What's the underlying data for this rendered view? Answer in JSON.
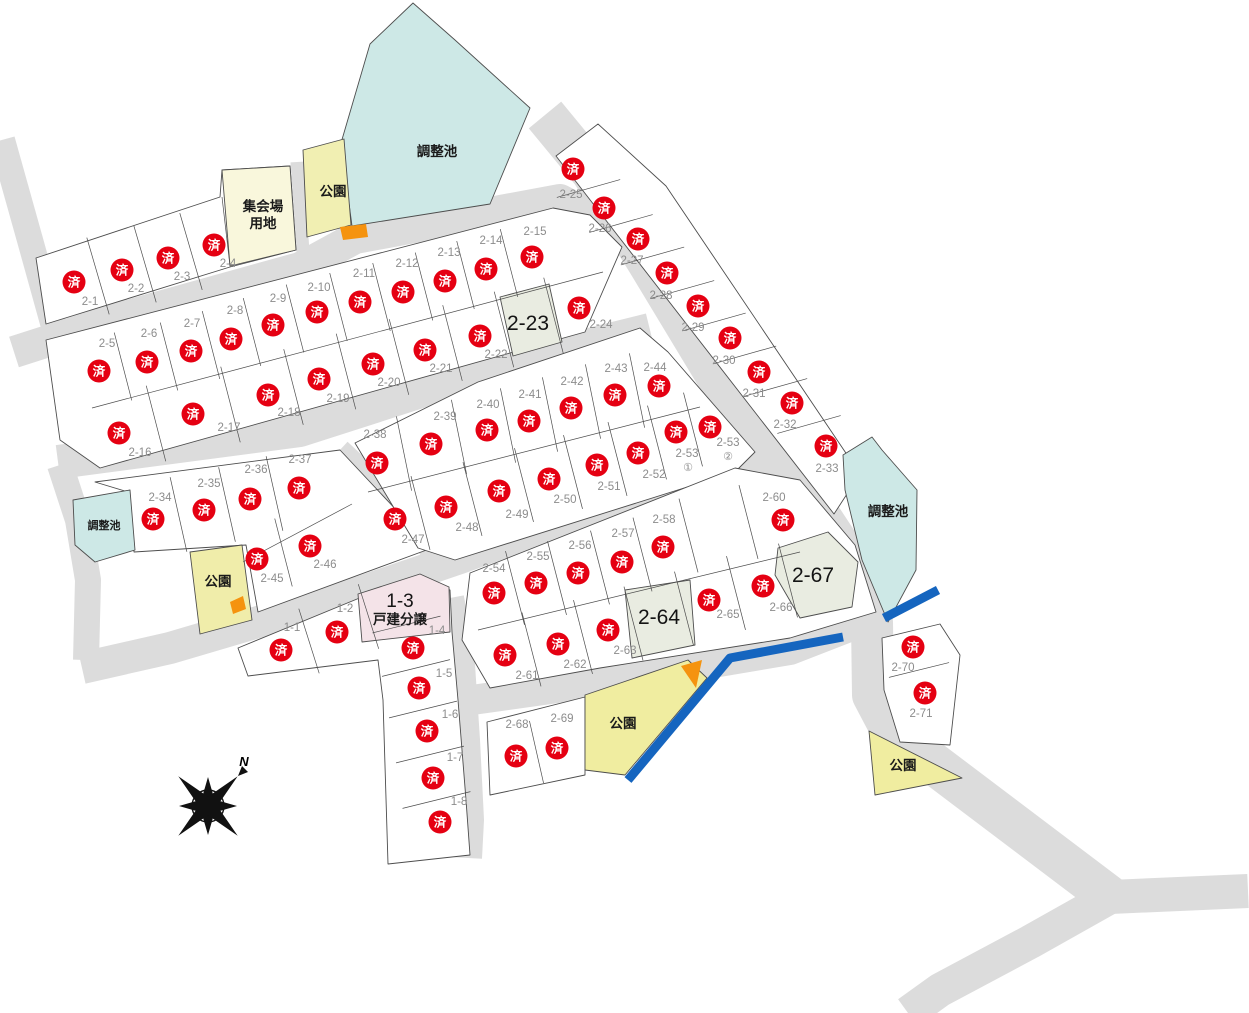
{
  "map": {
    "width": 1249,
    "height": 1013
  },
  "sold_mark": "済",
  "compass": {
    "label": "N"
  },
  "colors": {
    "road": "#dcdcdc",
    "lot_fill": "#ffffff",
    "lot_stroke": "#4d4d4d",
    "pond_fill": "#cde8e6",
    "park_fill": "#f0edaa",
    "hall_fill": "#f9f7dc",
    "pink_fill": "#f4e3e8",
    "available_fill": "#e9ece1",
    "sold_red": "#e50012",
    "water_blue": "#1565bf",
    "orange": "#f5930f",
    "label_gray": "#8c8c8c"
  },
  "area_labels": [
    {
      "text": "調整池",
      "x": 437,
      "y": 152,
      "size": 13.5
    },
    {
      "text": "調整池",
      "x": 104,
      "y": 525,
      "size": 11
    },
    {
      "text": "調整池",
      "x": 888,
      "y": 512,
      "size": 13.5
    },
    {
      "text": "公園",
      "x": 333,
      "y": 192,
      "size": 13.5
    },
    {
      "text": "公園",
      "x": 218,
      "y": 582,
      "size": 13.5
    },
    {
      "text": "公園",
      "x": 623,
      "y": 724,
      "size": 13.5
    },
    {
      "text": "公園",
      "x": 903,
      "y": 766,
      "size": 13.5
    },
    {
      "lines": [
        "集会場",
        "用地"
      ],
      "x": 263,
      "y": 207,
      "size": 13.5,
      "line_h": 17
    }
  ],
  "lots": [
    {
      "id": "2-1",
      "label": "2-1",
      "status": "sold",
      "x": 74,
      "y": 282,
      "lx": 90,
      "ly": 301
    },
    {
      "id": "2-2",
      "label": "2-2",
      "status": "sold",
      "x": 122,
      "y": 270,
      "lx": 136,
      "ly": 288
    },
    {
      "id": "2-3",
      "label": "2-3",
      "status": "sold",
      "x": 168,
      "y": 258,
      "lx": 182,
      "ly": 276
    },
    {
      "id": "2-4",
      "label": "2-4",
      "status": "sold",
      "x": 214,
      "y": 245,
      "lx": 228,
      "ly": 263
    },
    {
      "id": "2-5",
      "label": "2-5",
      "status": "sold",
      "x": 99,
      "y": 371,
      "lx": 107,
      "ly": 343
    },
    {
      "id": "2-6",
      "label": "2-6",
      "status": "sold",
      "x": 147,
      "y": 362,
      "lx": 149,
      "ly": 333
    },
    {
      "id": "2-7",
      "label": "2-7",
      "status": "sold",
      "x": 191,
      "y": 351,
      "lx": 192,
      "ly": 323
    },
    {
      "id": "2-8",
      "label": "2-8",
      "status": "sold",
      "x": 231,
      "y": 339,
      "lx": 235,
      "ly": 310
    },
    {
      "id": "2-9",
      "label": "2-9",
      "status": "sold",
      "x": 273,
      "y": 325,
      "lx": 278,
      "ly": 298
    },
    {
      "id": "2-10",
      "label": "2-10",
      "status": "sold",
      "x": 317,
      "y": 312,
      "lx": 319,
      "ly": 287
    },
    {
      "id": "2-11",
      "label": "2-11",
      "status": "sold",
      "x": 360,
      "y": 302,
      "lx": 364,
      "ly": 273
    },
    {
      "id": "2-12",
      "label": "2-12",
      "status": "sold",
      "x": 403,
      "y": 292,
      "lx": 407,
      "ly": 263
    },
    {
      "id": "2-13",
      "label": "2-13",
      "status": "sold",
      "x": 445,
      "y": 281,
      "lx": 449,
      "ly": 252
    },
    {
      "id": "2-14",
      "label": "2-14",
      "status": "sold",
      "x": 486,
      "y": 269,
      "lx": 491,
      "ly": 240
    },
    {
      "id": "2-15",
      "label": "2-15",
      "status": "sold",
      "x": 532,
      "y": 257,
      "lx": 535,
      "ly": 231
    },
    {
      "id": "2-16",
      "label": "2-16",
      "status": "sold",
      "x": 119,
      "y": 433,
      "lx": 140,
      "ly": 452
    },
    {
      "id": "2-17",
      "label": "2-17",
      "status": "sold",
      "x": 193,
      "y": 414,
      "lx": 229,
      "ly": 427
    },
    {
      "id": "2-18",
      "label": "2-18",
      "status": "sold",
      "x": 268,
      "y": 395,
      "lx": 289,
      "ly": 412
    },
    {
      "id": "2-19",
      "label": "2-19",
      "status": "sold",
      "x": 319,
      "y": 379,
      "lx": 338,
      "ly": 398
    },
    {
      "id": "2-20",
      "label": "2-20",
      "status": "sold",
      "x": 373,
      "y": 364,
      "lx": 389,
      "ly": 382
    },
    {
      "id": "2-21",
      "label": "2-21",
      "status": "sold",
      "x": 425,
      "y": 350,
      "lx": 441,
      "ly": 368
    },
    {
      "id": "2-22",
      "label": "2-22",
      "status": "sold",
      "x": 480,
      "y": 336,
      "lx": 496,
      "ly": 354
    },
    {
      "id": "2-23",
      "label": "2-23",
      "status": "available",
      "x": 528,
      "y": 323
    },
    {
      "id": "2-24",
      "label": "2-24",
      "status": "sold",
      "x": 579,
      "y": 308,
      "lx": 601,
      "ly": 324
    },
    {
      "id": "2-25",
      "label": "2-25",
      "status": "sold",
      "x": 573,
      "y": 169,
      "lx": 571,
      "ly": 194
    },
    {
      "id": "2-26",
      "label": "2-26",
      "status": "sold",
      "x": 604,
      "y": 208,
      "lx": 600,
      "ly": 228
    },
    {
      "id": "2-27",
      "label": "2-27",
      "status": "sold",
      "x": 638,
      "y": 239,
      "lx": 632,
      "ly": 260
    },
    {
      "id": "2-28",
      "label": "2-28",
      "status": "sold",
      "x": 667,
      "y": 273,
      "lx": 661,
      "ly": 295
    },
    {
      "id": "2-29",
      "label": "2-29",
      "status": "sold",
      "x": 698,
      "y": 306,
      "lx": 693,
      "ly": 327
    },
    {
      "id": "2-30",
      "label": "2-30",
      "status": "sold",
      "x": 730,
      "y": 338,
      "lx": 724,
      "ly": 360
    },
    {
      "id": "2-31",
      "label": "2-31",
      "status": "sold",
      "x": 759,
      "y": 372,
      "lx": 754,
      "ly": 393
    },
    {
      "id": "2-32",
      "label": "2-32",
      "status": "sold",
      "x": 792,
      "y": 403,
      "lx": 785,
      "ly": 424
    },
    {
      "id": "2-33",
      "label": "2-33",
      "status": "sold",
      "x": 826,
      "y": 446,
      "lx": 827,
      "ly": 468
    },
    {
      "id": "2-34",
      "label": "2-34",
      "status": "sold",
      "x": 153,
      "y": 519,
      "lx": 160,
      "ly": 497
    },
    {
      "id": "2-35",
      "label": "2-35",
      "status": "sold",
      "x": 204,
      "y": 510,
      "lx": 209,
      "ly": 483
    },
    {
      "id": "2-36",
      "label": "2-36",
      "status": "sold",
      "x": 250,
      "y": 499,
      "lx": 256,
      "ly": 469
    },
    {
      "id": "2-37",
      "label": "2-37",
      "status": "sold",
      "x": 299,
      "y": 488,
      "lx": 300,
      "ly": 459
    },
    {
      "id": "2-38",
      "label": "2-38",
      "status": "sold",
      "x": 377,
      "y": 463,
      "lx": 375,
      "ly": 434
    },
    {
      "id": "2-39",
      "label": "2-39",
      "status": "sold",
      "x": 431,
      "y": 444,
      "lx": 445,
      "ly": 416
    },
    {
      "id": "2-40",
      "label": "2-40",
      "status": "sold",
      "x": 487,
      "y": 430,
      "lx": 488,
      "ly": 404
    },
    {
      "id": "2-41",
      "label": "2-41",
      "status": "sold",
      "x": 529,
      "y": 421,
      "lx": 530,
      "ly": 394
    },
    {
      "id": "2-42",
      "label": "2-42",
      "status": "sold",
      "x": 571,
      "y": 408,
      "lx": 572,
      "ly": 381
    },
    {
      "id": "2-43",
      "label": "2-43",
      "status": "sold",
      "x": 615,
      "y": 395,
      "lx": 616,
      "ly": 368
    },
    {
      "id": "2-44",
      "label": "2-44",
      "status": "sold",
      "x": 659,
      "y": 386,
      "lx": 655,
      "ly": 367
    },
    {
      "id": "2-45",
      "label": "2-45",
      "status": "sold",
      "x": 257,
      "y": 559,
      "lx": 272,
      "ly": 578
    },
    {
      "id": "2-46",
      "label": "2-46",
      "status": "sold",
      "x": 310,
      "y": 546,
      "lx": 325,
      "ly": 564
    },
    {
      "id": "2-47",
      "label": "2-47",
      "status": "sold",
      "x": 395,
      "y": 519,
      "lx": 413,
      "ly": 539
    },
    {
      "id": "2-48",
      "label": "2-48",
      "status": "sold",
      "x": 446,
      "y": 507,
      "lx": 467,
      "ly": 527
    },
    {
      "id": "2-49",
      "label": "2-49",
      "status": "sold",
      "x": 499,
      "y": 491,
      "lx": 517,
      "ly": 514
    },
    {
      "id": "2-50",
      "label": "2-50",
      "status": "sold",
      "x": 549,
      "y": 479,
      "lx": 565,
      "ly": 499
    },
    {
      "id": "2-51",
      "label": "2-51",
      "status": "sold",
      "x": 597,
      "y": 465,
      "lx": 609,
      "ly": 486
    },
    {
      "id": "2-52",
      "label": "2-52",
      "status": "sold",
      "x": 638,
      "y": 453,
      "lx": 654,
      "ly": 474
    },
    {
      "id": "2-53-1",
      "label": "2-53",
      "sub": "①",
      "status": "sold",
      "x": 676,
      "y": 432,
      "lx": 687,
      "ly": 453,
      "sx": 688,
      "sy": 467
    },
    {
      "id": "2-53-2",
      "label": "2-53",
      "sub": "②",
      "status": "sold",
      "x": 710,
      "y": 427,
      "lx": 728,
      "ly": 442,
      "sx": 728,
      "sy": 456
    },
    {
      "id": "2-54",
      "label": "2-54",
      "status": "sold",
      "x": 494,
      "y": 593,
      "lx": 494,
      "ly": 568
    },
    {
      "id": "2-55",
      "label": "2-55",
      "status": "sold",
      "x": 536,
      "y": 583,
      "lx": 538,
      "ly": 556
    },
    {
      "id": "2-56",
      "label": "2-56",
      "status": "sold",
      "x": 578,
      "y": 573,
      "lx": 580,
      "ly": 545
    },
    {
      "id": "2-57",
      "label": "2-57",
      "status": "sold",
      "x": 622,
      "y": 562,
      "lx": 623,
      "ly": 533
    },
    {
      "id": "2-58",
      "label": "2-58",
      "status": "sold",
      "x": 663,
      "y": 547,
      "lx": 664,
      "ly": 519
    },
    {
      "id": "unlabeled-1",
      "label": "",
      "status": "vacant",
      "x": 714,
      "y": 524
    },
    {
      "id": "2-60",
      "label": "2-60",
      "status": "sold",
      "x": 783,
      "y": 520,
      "lx": 774,
      "ly": 497
    },
    {
      "id": "2-61",
      "label": "2-61",
      "status": "sold",
      "x": 505,
      "y": 655,
      "lx": 527,
      "ly": 675
    },
    {
      "id": "2-62",
      "label": "2-62",
      "status": "sold",
      "x": 558,
      "y": 644,
      "lx": 575,
      "ly": 664
    },
    {
      "id": "2-63",
      "label": "2-63",
      "status": "sold",
      "x": 608,
      "y": 630,
      "lx": 625,
      "ly": 650
    },
    {
      "id": "2-64",
      "label": "2-64",
      "status": "available",
      "x": 659,
      "y": 617
    },
    {
      "id": "2-65",
      "label": "2-65",
      "status": "sold",
      "x": 709,
      "y": 600,
      "lx": 728,
      "ly": 614
    },
    {
      "id": "2-66",
      "label": "2-66",
      "status": "sold",
      "x": 763,
      "y": 586,
      "lx": 781,
      "ly": 607
    },
    {
      "id": "2-67",
      "label": "2-67",
      "status": "available",
      "x": 813,
      "y": 575
    },
    {
      "id": "2-68",
      "label": "2-68",
      "status": "sold",
      "x": 516,
      "y": 756,
      "lx": 517,
      "ly": 724
    },
    {
      "id": "2-69",
      "label": "2-69",
      "status": "sold",
      "x": 557,
      "y": 748,
      "lx": 562,
      "ly": 718
    },
    {
      "id": "2-70",
      "label": "2-70",
      "status": "sold",
      "x": 913,
      "y": 647,
      "lx": 903,
      "ly": 667
    },
    {
      "id": "2-71",
      "label": "2-71",
      "status": "sold",
      "x": 925,
      "y": 693,
      "lx": 921,
      "ly": 713
    },
    {
      "id": "1-1",
      "label": "1-1",
      "status": "sold",
      "x": 281,
      "y": 650,
      "lx": 292,
      "ly": 627
    },
    {
      "id": "1-2",
      "label": "1-2",
      "status": "sold",
      "x": 337,
      "y": 632,
      "lx": 345,
      "ly": 608
    },
    {
      "id": "1-3",
      "label": "1-3",
      "sub": "戸建分譲",
      "status": "subdivision",
      "x": 400,
      "y": 601,
      "sx": 400,
      "sy": 619
    },
    {
      "id": "1-4",
      "label": "1-4",
      "status": "sold",
      "x": 413,
      "y": 648,
      "lx": 437,
      "ly": 630
    },
    {
      "id": "1-5",
      "label": "1-5",
      "status": "sold",
      "x": 419,
      "y": 688,
      "lx": 444,
      "ly": 673
    },
    {
      "id": "1-6",
      "label": "1-6",
      "status": "sold",
      "x": 427,
      "y": 731,
      "lx": 450,
      "ly": 714
    },
    {
      "id": "1-7",
      "label": "1-7",
      "status": "sold",
      "x": 433,
      "y": 778,
      "lx": 455,
      "ly": 757
    },
    {
      "id": "1-8",
      "label": "1-8",
      "status": "sold",
      "x": 440,
      "y": 822,
      "lx": 459,
      "ly": 801
    }
  ],
  "divider_rows": [
    {
      "ids": [
        "2-1",
        "2-2",
        "2-3",
        "2-4"
      ],
      "dir": [
        0.28,
        0.96
      ],
      "len": 80
    },
    {
      "ids": [
        "2-5",
        "2-6",
        "2-7",
        "2-8",
        "2-9",
        "2-10",
        "2-11",
        "2-12",
        "2-13",
        "2-14",
        "2-15"
      ],
      "dir": [
        0.25,
        0.97
      ],
      "len": 70
    },
    {
      "ids": [
        "2-16",
        "2-17",
        "2-18",
        "2-19",
        "2-20",
        "2-21",
        "2-22",
        "2-23",
        "2-24"
      ],
      "dir": [
        0.25,
        0.97
      ],
      "len": 78
    },
    {
      "ids": [
        "2-25",
        "2-26",
        "2-27",
        "2-28",
        "2-29",
        "2-30",
        "2-31",
        "2-32",
        "2-33"
      ],
      "dir": [
        0.96,
        -0.27
      ],
      "len": 66
    },
    {
      "ids": [
        "2-34",
        "2-35",
        "2-36",
        "2-37"
      ],
      "dir": [
        0.22,
        0.98
      ],
      "len": 76
    },
    {
      "ids": [
        "2-45",
        "2-46"
      ],
      "dir": [
        0.25,
        0.97
      ],
      "len": 70
    },
    {
      "ids": [
        "2-38",
        "2-39",
        "2-40",
        "2-41",
        "2-42",
        "2-43",
        "2-44"
      ],
      "dir": [
        0.2,
        0.98
      ],
      "len": 76
    },
    {
      "ids": [
        "2-47",
        "2-48",
        "2-49",
        "2-50",
        "2-51",
        "2-52",
        "2-53-1",
        "2-53-2"
      ],
      "dir": [
        0.25,
        0.97
      ],
      "len": 76
    },
    {
      "ids": [
        "2-54",
        "2-55",
        "2-56",
        "2-57",
        "2-58",
        "unlabeled-1",
        "2-60"
      ],
      "dir": [
        0.25,
        0.97
      ],
      "len": 76
    },
    {
      "ids": [
        "2-61",
        "2-62",
        "2-63",
        "2-64",
        "2-65",
        "2-66",
        "2-67"
      ],
      "dir": [
        0.25,
        0.97
      ],
      "len": 76
    },
    {
      "ids": [
        "1-1",
        "1-2",
        "1-3"
      ],
      "dir": [
        0.3,
        0.95
      ],
      "len": 68
    },
    {
      "ids": [
        "1-3",
        "1-4",
        "1-5",
        "1-6",
        "1-7",
        "1-8"
      ],
      "dir": [
        0.97,
        -0.24
      ],
      "len": 70
    },
    {
      "ids": [
        "2-68",
        "2-69"
      ],
      "dir": [
        0.22,
        0.97
      ],
      "len": 64
    },
    {
      "ids": [
        "2-70",
        "2-71"
      ],
      "dir": [
        0.97,
        -0.24
      ],
      "len": 62
    }
  ]
}
